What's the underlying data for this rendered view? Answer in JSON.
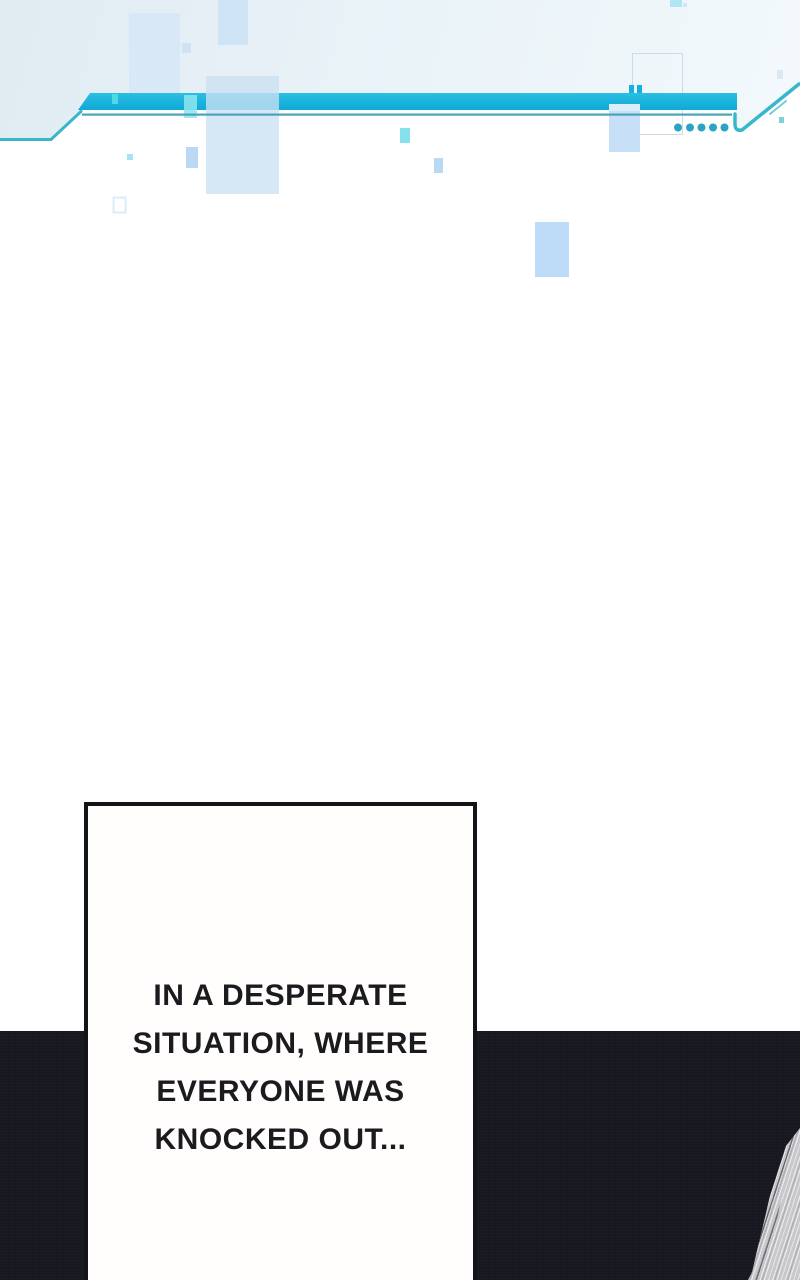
{
  "panel": {
    "kind": "webtoon-episode-panel",
    "narration": {
      "lines": [
        "IN A DESPERATE",
        "SITUATION, WHERE",
        "EVERYONE WAS",
        "KNOCKED OUT..."
      ],
      "full_text": "IN A DESPERATE SITUATION, WHERE EVERYONE WAS KNOCKED OUT..."
    }
  },
  "theme": {
    "accent_cyan": "#14b2dc",
    "accent_cyan_light": "#4fd8e8",
    "accent_teal": "#38b6ca",
    "line_teal": "#4aa4b5",
    "dot_teal": "#2ba3c3",
    "blue_pale": "#d9e8f6",
    "blue_mid": "#bedcf7",
    "cyan_pale": "#8ee6f0",
    "band_tint": "#e4eef4",
    "outline_blue": "#ccdbe8",
    "panel_dark": "#16171f",
    "ink": "#141418",
    "box_bg": "#fffefc",
    "sketch_gray": "#c8c8cc"
  }
}
